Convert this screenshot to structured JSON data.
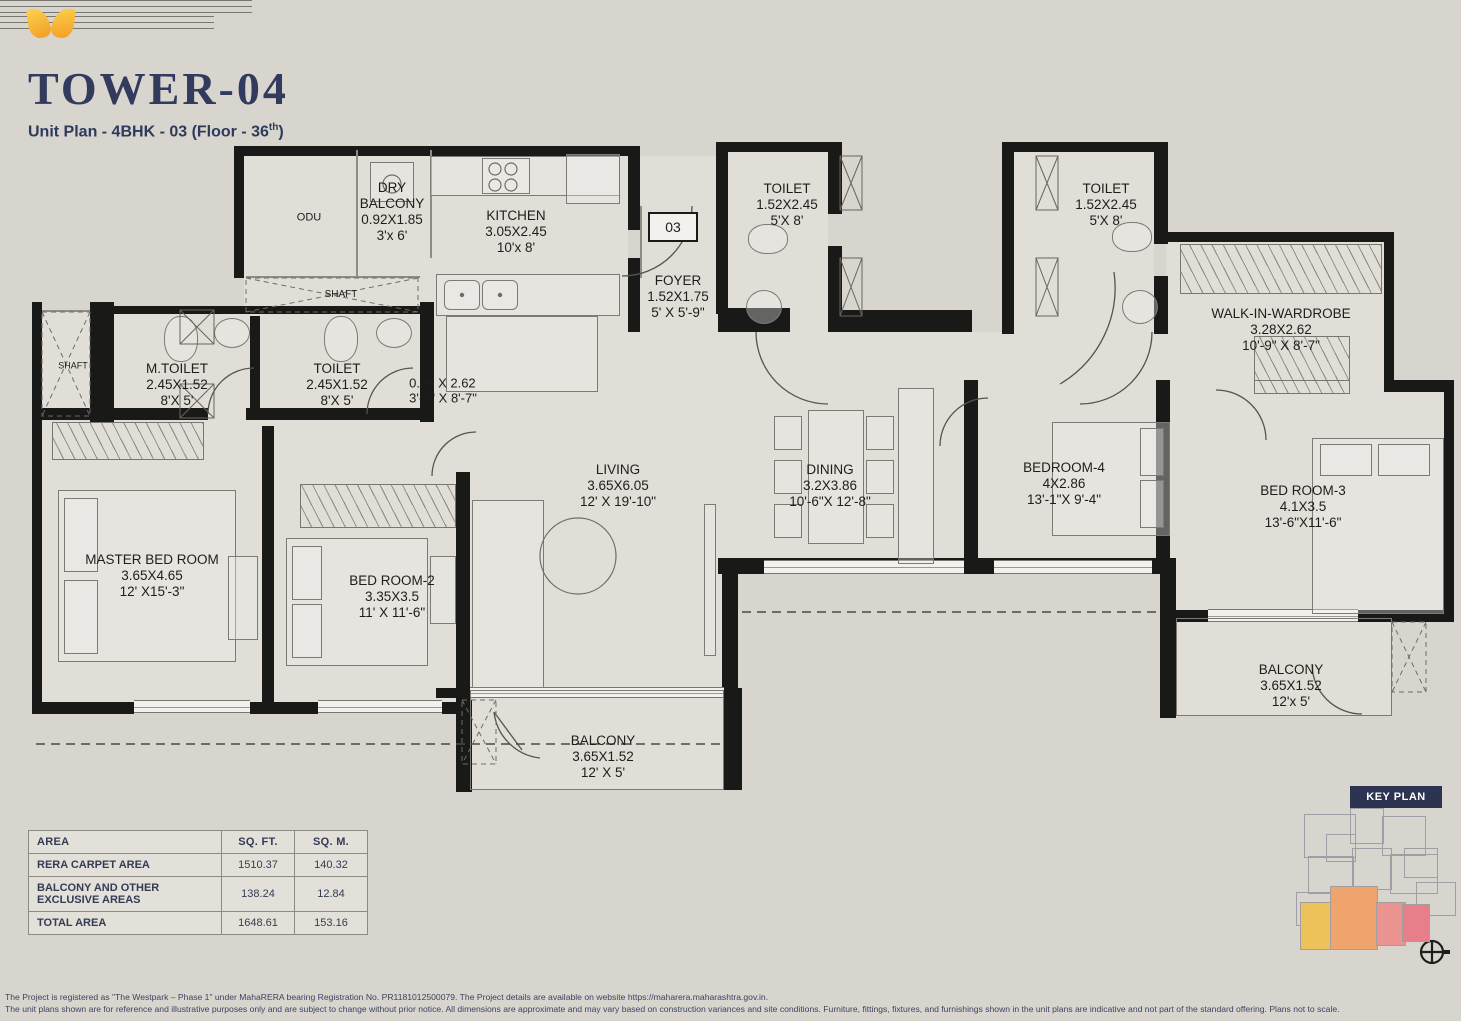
{
  "header": {
    "title": "TOWER-04",
    "subtitle_prefix": "Unit Plan - 4BHK - 03 (Floor - 36",
    "subtitle_sup": "th",
    "subtitle_suffix": ")",
    "logo": "westpark-wings-logo"
  },
  "plan": {
    "entry_door_label": "03",
    "rooms": [
      {
        "id": "odu",
        "lines": [
          "ODU"
        ]
      },
      {
        "id": "dry_balcony",
        "lines": [
          "DRY",
          "BALCONY",
          "0.92X1.85",
          "3'x 6'"
        ]
      },
      {
        "id": "kitchen",
        "lines": [
          "KITCHEN",
          "3.05X2.45",
          "10'x 8'"
        ]
      },
      {
        "id": "shaft_top",
        "lines": [
          "SHAFT"
        ]
      },
      {
        "id": "shaft_left",
        "lines": [
          "SHAFT"
        ]
      },
      {
        "id": "m_toilet",
        "lines": [
          "M.TOILET",
          "2.45X1.52",
          "8'X 5'"
        ]
      },
      {
        "id": "toilet_common",
        "lines": [
          "TOILET",
          "2.45X1.52",
          "8'X 5'"
        ]
      },
      {
        "id": "passage",
        "lines": [
          "0.98 X 2.62",
          "3'-2\" X 8'-7\""
        ]
      },
      {
        "id": "foyer",
        "lines": [
          "FOYER",
          "1.52X1.75",
          "5' X 5'-9\""
        ]
      },
      {
        "id": "toilet_3",
        "lines": [
          "TOILET",
          "1.52X2.45",
          "5'X 8'"
        ]
      },
      {
        "id": "toilet_4",
        "lines": [
          "TOILET",
          "1.52X2.45",
          "5'X 8'"
        ]
      },
      {
        "id": "walk_in_wardrobe",
        "lines": [
          "WALK-IN-WARDROBE",
          "3.28X2.62",
          "10'-9\" X 8'-7\""
        ]
      },
      {
        "id": "living",
        "lines": [
          "LIVING",
          "3.65X6.05",
          "12' X 19'-10\""
        ]
      },
      {
        "id": "dining",
        "lines": [
          "DINING",
          "3.2X3.86",
          "10'-6\"X 12'-8\""
        ]
      },
      {
        "id": "master_bedroom",
        "lines": [
          "MASTER BED ROOM",
          "3.65X4.65",
          "12' X15'-3\""
        ]
      },
      {
        "id": "bedroom_2",
        "lines": [
          "BED ROOM-2",
          "3.35X3.5",
          "11' X 11'-6\""
        ]
      },
      {
        "id": "bedroom_4",
        "lines": [
          "BEDROOM-4",
          "4X2.86",
          "13'-1\"X 9'-4\""
        ]
      },
      {
        "id": "bedroom_3",
        "lines": [
          "BED ROOM-3",
          "4.1X3.5",
          "13'-6\"X11'-6\""
        ]
      },
      {
        "id": "balcony_bottom",
        "lines": [
          "BALCONY",
          "3.65X1.52",
          "12' X 5'"
        ]
      },
      {
        "id": "balcony_right",
        "lines": [
          "BALCONY",
          "3.65X1.52",
          "12'x 5'"
        ]
      }
    ]
  },
  "area_table": {
    "headers": [
      "AREA",
      "SQ. FT.",
      "SQ. M."
    ],
    "rows": [
      [
        "RERA CARPET AREA",
        "1510.37",
        "140.32"
      ],
      [
        "BALCONY AND OTHER EXCLUSIVE AREAS",
        "138.24",
        "12.84"
      ],
      [
        "TOTAL AREA",
        "1648.61",
        "153.16"
      ]
    ]
  },
  "key_plan": {
    "label": "KEY PLAN",
    "highlight_colors": [
      "#eec25b",
      "#efa46e",
      "#eb9390",
      "#e77f8a"
    ]
  },
  "footer": {
    "line1": "The Project is registered as \"The Westpark – Phase 1\" under MahaRERA bearing Registration No. PR1181012500079. The Project details are available on website https://maharera.maharashtra.gov.in.",
    "line2": "The unit plans shown are for reference and illustrative purposes only and are subject to change without prior notice. All dimensions are approximate and may vary based on construction variances and site conditions. Furniture, fittings, fixtures, and furnishings shown in the unit plans are indicative and not part of the standard offering. Plans not to scale."
  },
  "colors": {
    "title_navy": "#2e3a5c",
    "wall_black": "#191918",
    "page_bg": "#d8d5ce",
    "logo_orange": "#f29c26",
    "badge_navy": "#2c3452"
  }
}
